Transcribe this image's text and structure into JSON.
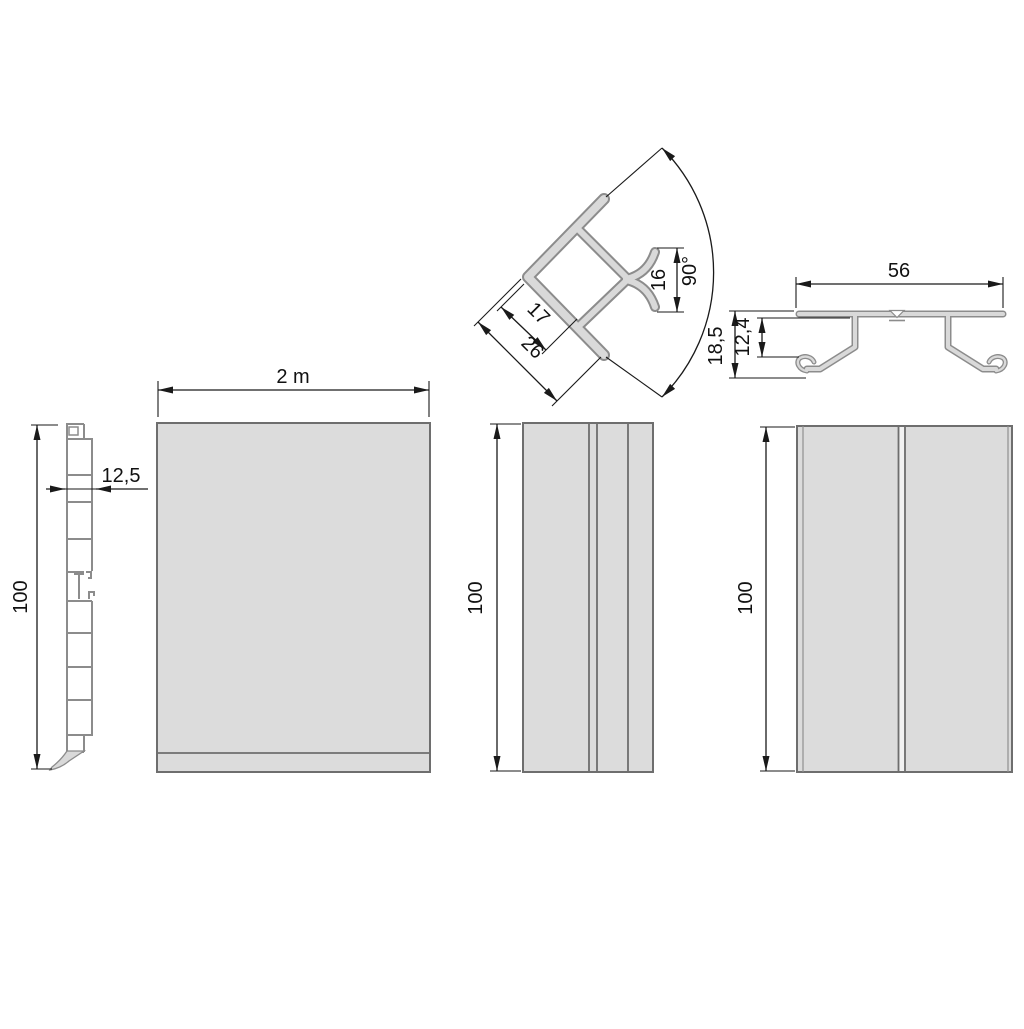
{
  "drawing": {
    "views": {
      "side_profile": {
        "height_label": "100",
        "thickness_label": "12,5"
      },
      "main_panel": {
        "length_label": "2 m"
      },
      "corner_profile": {
        "inner_width_label": "17",
        "outer_width_label": "26",
        "clip_opening_label": "16",
        "angle_label": "90°"
      },
      "clip_profile": {
        "width_label": "56",
        "total_height_label": "18,5",
        "inner_height_label": "12,4"
      },
      "mid_panel": {
        "height_label": "100"
      },
      "right_panel": {
        "height_label": "100"
      }
    },
    "colors": {
      "background": "#ffffff",
      "panel_fill": "#dcdcdc",
      "panel_border": "#6e6e6e",
      "profile_fill": "#d9d9d9",
      "profile_outline": "#8c8c8c",
      "dimension": "#1a1a1a"
    }
  }
}
